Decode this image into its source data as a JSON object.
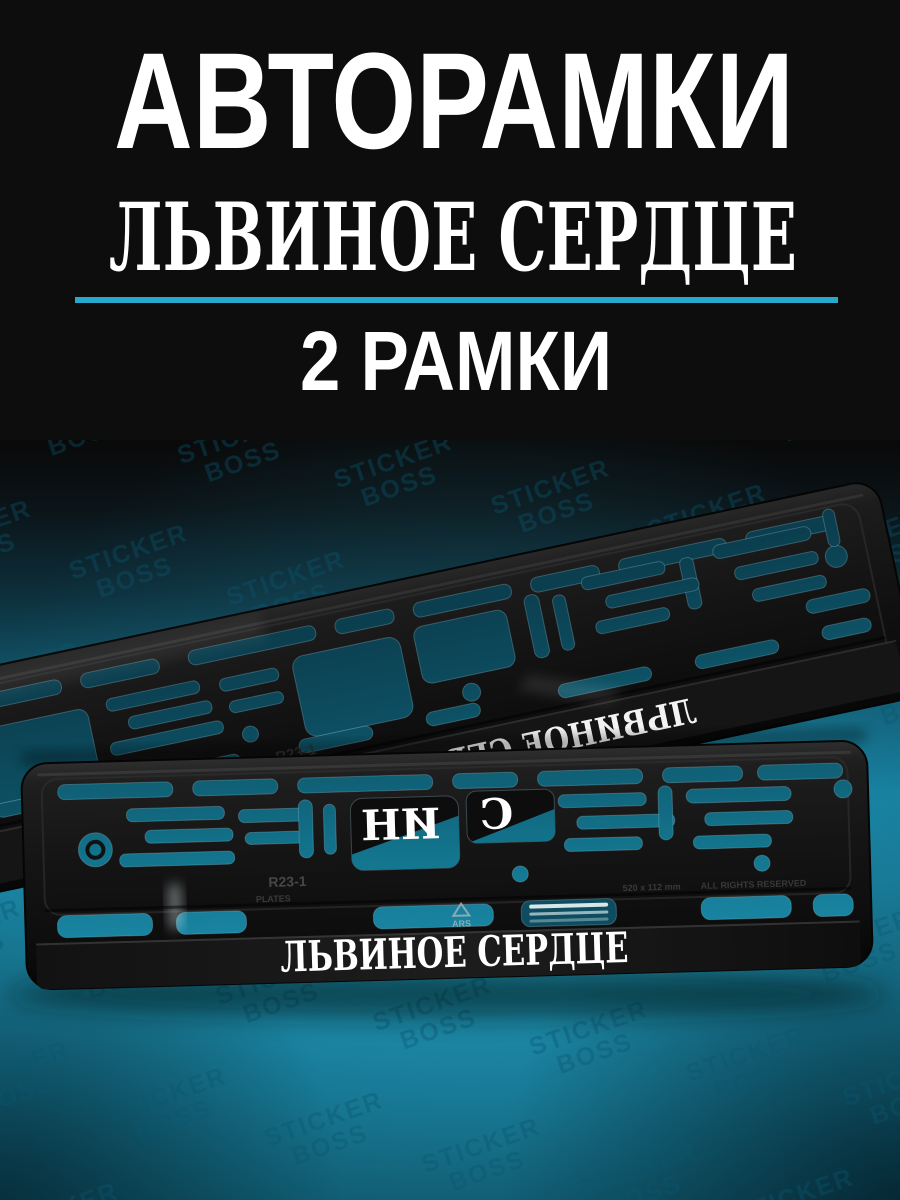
{
  "header": {
    "title": "АВТОРАМКИ",
    "subtitle": "ЛЬВИНОЕ СЕРДЦЕ",
    "count": "2 РАМКИ"
  },
  "photo": {
    "watermark": {
      "line1": "STICKER",
      "line2": "BOSS"
    },
    "frames": {
      "count": 2,
      "print_text": "ЛЬВИНОЕ СЕРДЦЕ",
      "mirrored_back_text": "ЛЬВИНОЕ СЕРДЦЕ",
      "back_text_fragment_left": "ИН",
      "back_text_fragment_right": "С",
      "embossed": {
        "model": "R23-1",
        "size_label": "520 x 112 mm",
        "rights_label": "ALL RIGHTS RESERVED",
        "plates_label": "PLATES",
        "logo": "ARS"
      }
    }
  },
  "theme": {
    "page_black": "#0d0d0d",
    "divider_cyan": "#29a8cd",
    "teal_glow": "#1b88a7",
    "frame_black": "#141414",
    "print_white": "#ffffff"
  }
}
